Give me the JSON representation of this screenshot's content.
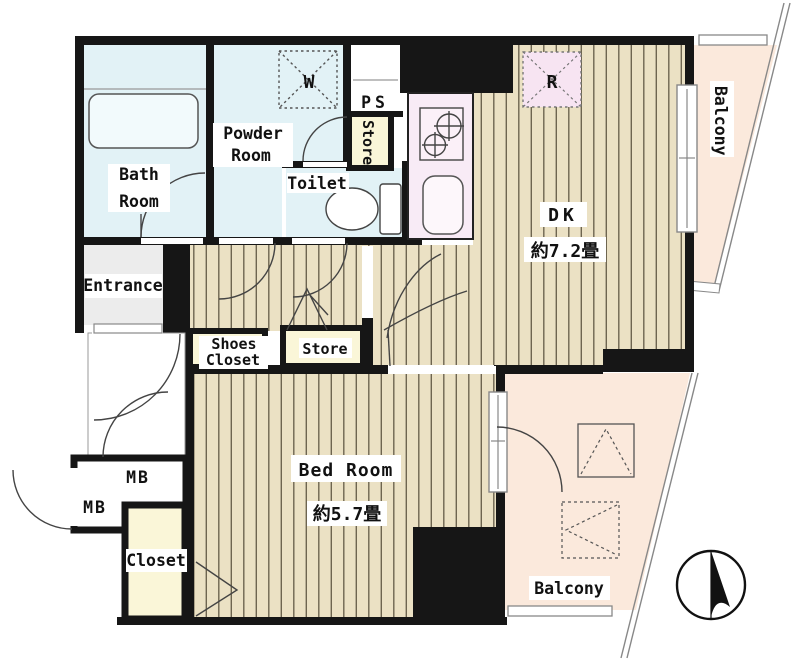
{
  "floorplan": {
    "unit_labels": {
      "bath_line1": "Bath",
      "bath_line2": "Room",
      "powder_line1": "Powder",
      "powder_line2": "Room",
      "toilet": "Toilet",
      "ps": "PS",
      "store_upper": "Store",
      "washer_symbol": "W",
      "fridge_symbol": "R",
      "dk": "DK",
      "dk_size": "約7.2畳",
      "balcony_right": "Balcony",
      "entrance": "Entrance",
      "shoes_line1": "Shoes",
      "shoes_line2": "Closet",
      "store_hall": "Store",
      "bedroom": "Bed Room",
      "bedroom_size": "約5.7畳",
      "mb_upper": "MB",
      "mb_lower": "MB",
      "closet": "Closet",
      "balcony_bottom": "Balcony"
    },
    "colors": {
      "wall": "#161616",
      "wet_room": "#E2F2F6",
      "wood_floor": "#EBE1C4",
      "floor_stripe": "#6E6550",
      "kitchen": "#F8EBF6",
      "kitchen_fixture": "#F7E4F2",
      "closet_yellow": "#FAF6D8",
      "balcony": "#FBE9DC",
      "entrance_gray": "#ECECEC",
      "outline": "#555555"
    }
  }
}
